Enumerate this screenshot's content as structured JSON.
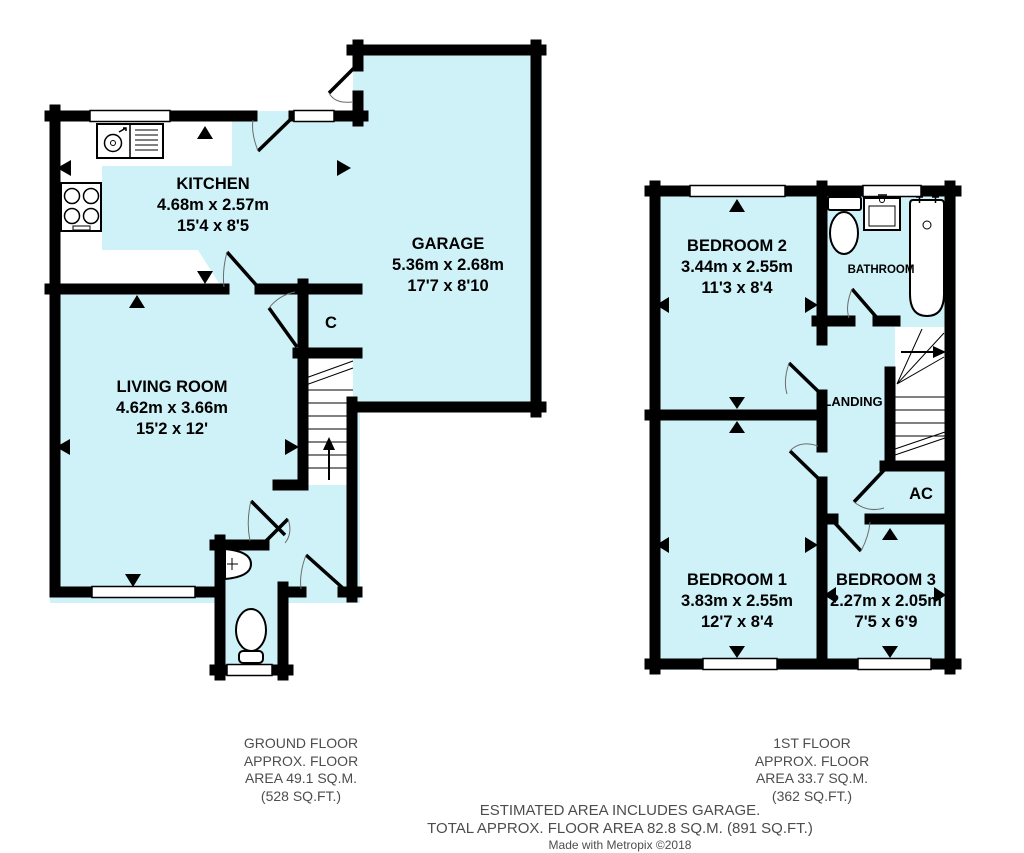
{
  "ground_floor": {
    "caption": [
      "GROUND FLOOR",
      "APPROX. FLOOR",
      "AREA 49.1 SQ.M.",
      "(528 SQ.FT.)"
    ],
    "rooms": {
      "kitchen": {
        "name": "KITCHEN",
        "metric": "4.68m x 2.57m",
        "imperial": "15'4 x 8'5"
      },
      "garage": {
        "name": "GARAGE",
        "metric": "5.36m x 2.68m",
        "imperial": "17'7 x 8'10"
      },
      "living_room": {
        "name": "LIVING ROOM",
        "metric": "4.62m x 3.66m",
        "imperial": "15'2 x 12'"
      },
      "cupboard": {
        "name": "C"
      }
    },
    "fixtures": [
      "kitchen-sink-icon",
      "hob-icon",
      "toilet-icon",
      "basin-icon",
      "staircase-up-icon"
    ]
  },
  "first_floor": {
    "caption": [
      "1ST FLOOR",
      "APPROX. FLOOR",
      "AREA 33.7 SQ.M.",
      "(362 SQ.FT.)"
    ],
    "rooms": {
      "bedroom2": {
        "name": "BEDROOM 2",
        "metric": "3.44m x 2.55m",
        "imperial": "11'3 x 8'4"
      },
      "bathroom": {
        "name": "BATHROOM"
      },
      "landing": {
        "name": "LANDING"
      },
      "airing_cupboard": {
        "name": "AC"
      },
      "bedroom1": {
        "name": "BEDROOM 1",
        "metric": "3.83m x 2.55m",
        "imperial": "12'7 x 8'4"
      },
      "bedroom3": {
        "name": "BEDROOM 3",
        "metric": "2.27m x 2.05m",
        "imperial": "7'5 x 6'9"
      }
    },
    "fixtures": [
      "toilet-icon",
      "basin-icon",
      "bath-icon",
      "staircase-icon"
    ]
  },
  "footer": {
    "line1": "ESTIMATED AREA INCLUDES GARAGE.",
    "line2": "TOTAL APPROX. FLOOR AREA 82.8 SQ.M. (891 SQ.FT.)",
    "credit": "Made with Metropix ©2018"
  },
  "colors": {
    "room_fill": "#CFF2F8",
    "wall": "#000000",
    "caption_text": "#4D4D4D"
  }
}
